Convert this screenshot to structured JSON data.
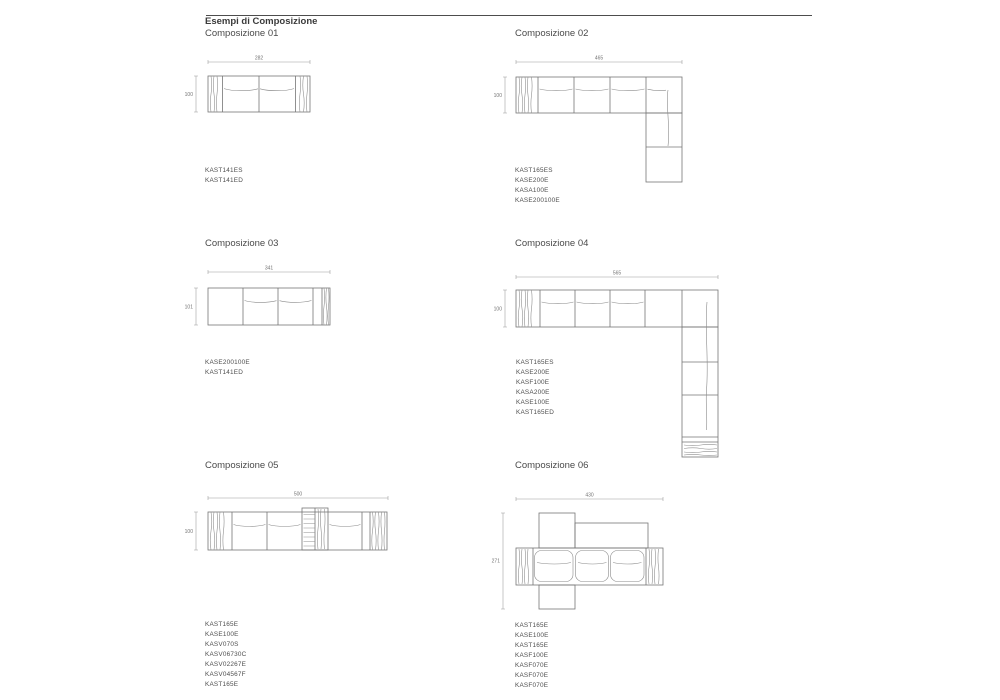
{
  "page": {
    "header_title": "Esempi di Composizione"
  },
  "compositions": [
    {
      "title": "Composizione 01",
      "width_dim": "282",
      "height_dim": "100",
      "codes": [
        "KAST141ES",
        "KAST141ED"
      ]
    },
    {
      "title": "Composizione 02",
      "width_dim": "465",
      "height_dim": "100",
      "codes": [
        "KAST165ES",
        "KASE200E",
        "KASA100E",
        "KASE200100E"
      ]
    },
    {
      "title": "Composizione 03",
      "width_dim": "341",
      "height_dim": "101",
      "codes": [
        "KASE200100E",
        "KAST141ED"
      ]
    },
    {
      "title": "Composizione 04",
      "width_dim": "565",
      "height_dim": "100",
      "codes": [
        "KAST165ES",
        "KASE200E",
        "KASF100E",
        "KASA200E",
        "KASE100E",
        "KAST165ED"
      ]
    },
    {
      "title": "Composizione 05",
      "width_dim": "500",
      "height_dim": "100",
      "codes": [
        "KAST165E",
        "KASE100E",
        "KASV070S",
        "KASV06730C",
        "KASV02267E",
        "KASV04567F",
        "KAST165E"
      ]
    },
    {
      "title": "Composizione 06",
      "width_dim": "430",
      "height_dim": "271",
      "codes": [
        "KAST165E",
        "KASE100E",
        "KAST165E",
        "KASF100E",
        "KASF070E",
        "KASF070E",
        "KASF070E"
      ]
    }
  ]
}
